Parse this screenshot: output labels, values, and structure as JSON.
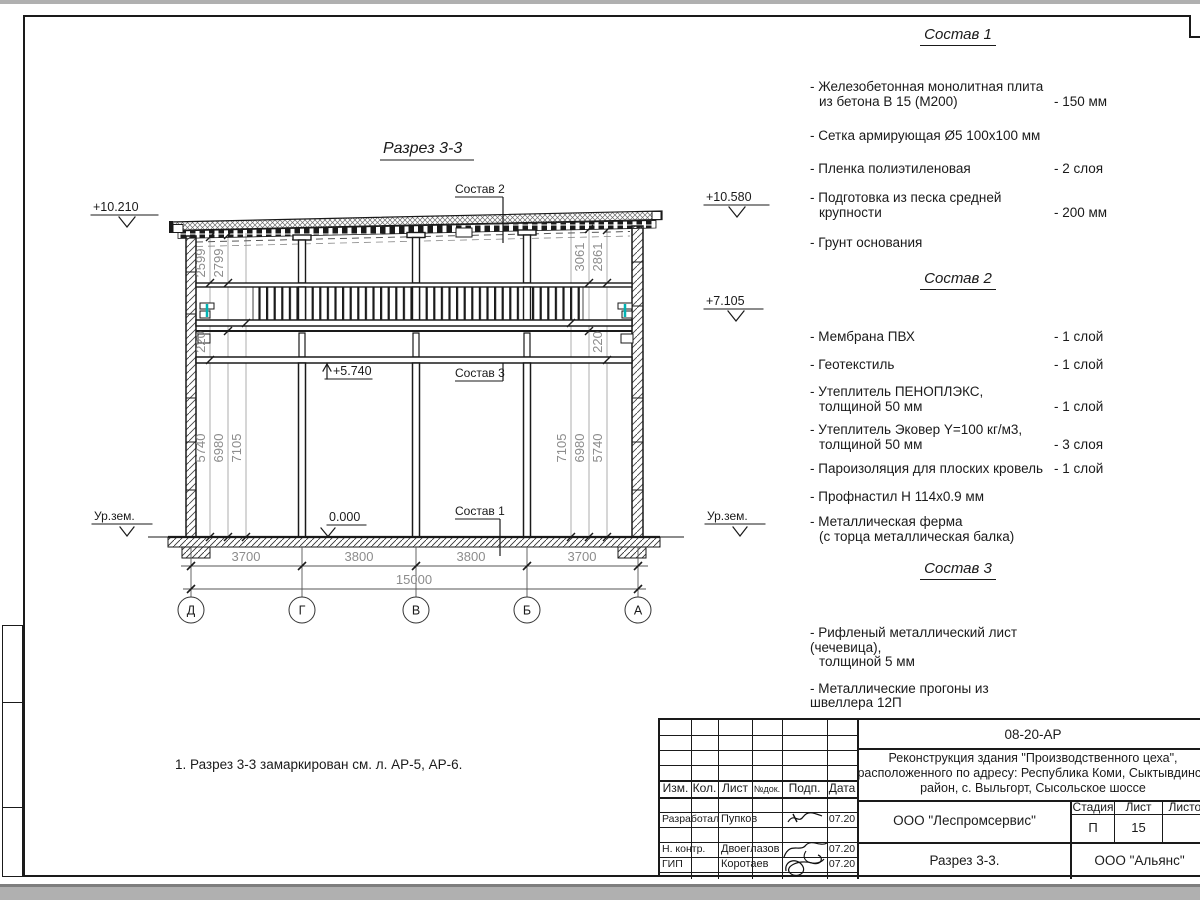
{
  "colors": {
    "line": "#1a1a1a",
    "dim": "#8c8c8c",
    "accent_cyan": "#00b3b3"
  },
  "drawing": {
    "title": "Разрез 3-3",
    "callouts": {
      "sostav1": "Состав 1",
      "sostav2": "Состав 2",
      "sostav3": "Состав 3"
    },
    "ground_label": "Ур.зем.",
    "elevations": {
      "left_top": "+10.210",
      "right_top": "+10.580",
      "right_mid": "+7.105",
      "floor": "+5.740",
      "zero": "0.000"
    },
    "dims": {
      "left_top": [
        "2599",
        "2799"
      ],
      "left_gap": "220",
      "left_heights": [
        "5740",
        "6980",
        "7105"
      ],
      "right_top": [
        "3061",
        "2861"
      ],
      "right_gap": "220",
      "right_heights": [
        "7105",
        "6980",
        "5740"
      ],
      "spans": [
        "3700",
        "3800",
        "3800",
        "3700"
      ],
      "total": "15000"
    },
    "axes": [
      "Д",
      "Г",
      "В",
      "Б",
      "А"
    ]
  },
  "note": "1. Разрез 3-3 замаркирован см. л. АР-5, АР-6.",
  "compositions": [
    {
      "title": "Состав 1",
      "items": [
        {
          "name": "- Железобетонная  монолитная плита",
          "name2": "из бетона В 15 (М200)",
          "value": "- 150 мм"
        },
        {
          "name": "- Сетка армирующая Ø5 100х100 мм",
          "value": ""
        },
        {
          "name": "- Пленка полиэтиленовая",
          "value": "-  2 слоя"
        },
        {
          "name": "- Подготовка из песка средней",
          "name2": "крупности",
          "value": "- 200 мм"
        },
        {
          "name": "- Грунт основания",
          "value": ""
        }
      ]
    },
    {
      "title": "Состав 2",
      "items": [
        {
          "name": "- Мембрана ПВХ",
          "value": "- 1 слой"
        },
        {
          "name": "- Геотекстиль",
          "value": "- 1 слой"
        },
        {
          "name": "- Утеплитель ПЕНОПЛЭКС,",
          "name2": "толщиной 50 мм",
          "value": "- 1 слой"
        },
        {
          "name": "- Утеплитель Эковер Y=100 кг/м3,",
          "name2": "толщиной 50 мм",
          "value": "- 3 слоя"
        },
        {
          "name": "- Пароизоляция для плоских кровель",
          "value": "- 1 слой"
        },
        {
          "name": "- Профнастил Н 114х0.9 мм",
          "value": ""
        },
        {
          "name": "- Металлическая ферма",
          "name2": "(с торца металлическая балка)",
          "value": ""
        }
      ]
    },
    {
      "title": "Состав 3",
      "items": [
        {
          "name": "- Рифленый металлический лист (чечевица),",
          "name2": "толщиной 5 мм",
          "value": ""
        },
        {
          "name": "- Металлические прогоны из швеллера 12П",
          "value": ""
        }
      ]
    }
  ],
  "titleblock": {
    "code": "08-20-АР",
    "project_line1": "Реконструкция здания \"Производственного цеха\",",
    "project_line2": "расположенного по адресу: Республика Коми, Сыктывдинский",
    "project_line3": "район, с. Выльгорт, Сысольское шоссе",
    "org": "ООО \"Леспромсервис\"",
    "doc_title": "Разрез 3-3.",
    "company": "ООО \"Альянс\"",
    "stage_label": "Стадия",
    "sheet_label": "Лист",
    "sheets_label": "Листов",
    "stage_value": "П",
    "sheet_value": "15",
    "cols": [
      "Изм.",
      "Кол.",
      "Лист",
      "№док.",
      "Подп.",
      "Дата"
    ],
    "r1": {
      "role": "Разработал",
      "name": "Пупков",
      "date": "07.20"
    },
    "r2": {
      "role": "Н. контр.",
      "name": "Двоеглазов",
      "date": "07.20"
    },
    "r3": {
      "role": "ГИП",
      "name": "Коротаев",
      "date": "07.20"
    }
  }
}
